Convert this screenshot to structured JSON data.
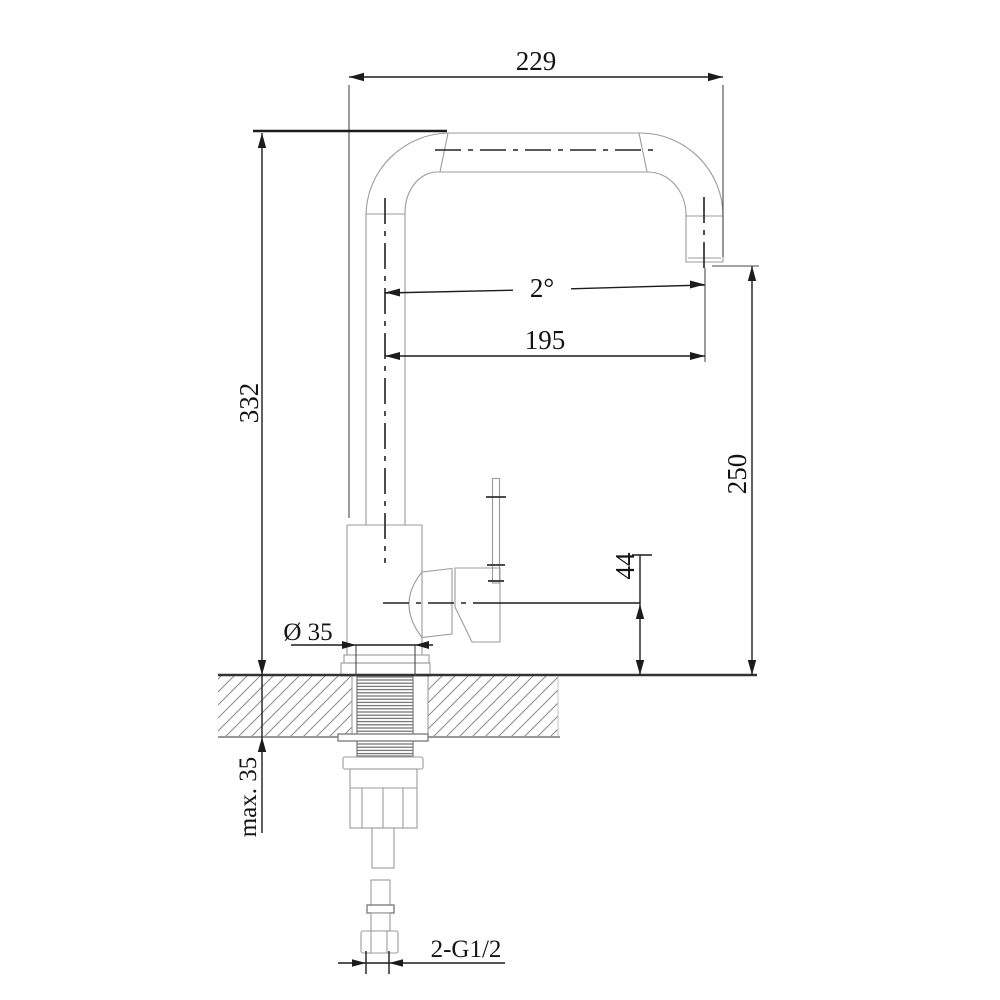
{
  "drawing": {
    "type": "technical-drawing",
    "subject": "kitchen-faucet-installation-dimensions",
    "dimensions": {
      "top_width": "229",
      "spout_angle": "2°",
      "spout_reach": "195",
      "height_total": "332",
      "height_spout": "250",
      "outlet_to_counter": "44",
      "base_diameter": "Ø 35",
      "max_counter_thickness": "max. 35",
      "inlet_thread": "2-G1/2"
    },
    "colors": {
      "dimension_line": "#1c1c1c",
      "object_line": "#9b9b9b",
      "hatch_line": "#8a8a8a",
      "background": "#ffffff"
    }
  }
}
